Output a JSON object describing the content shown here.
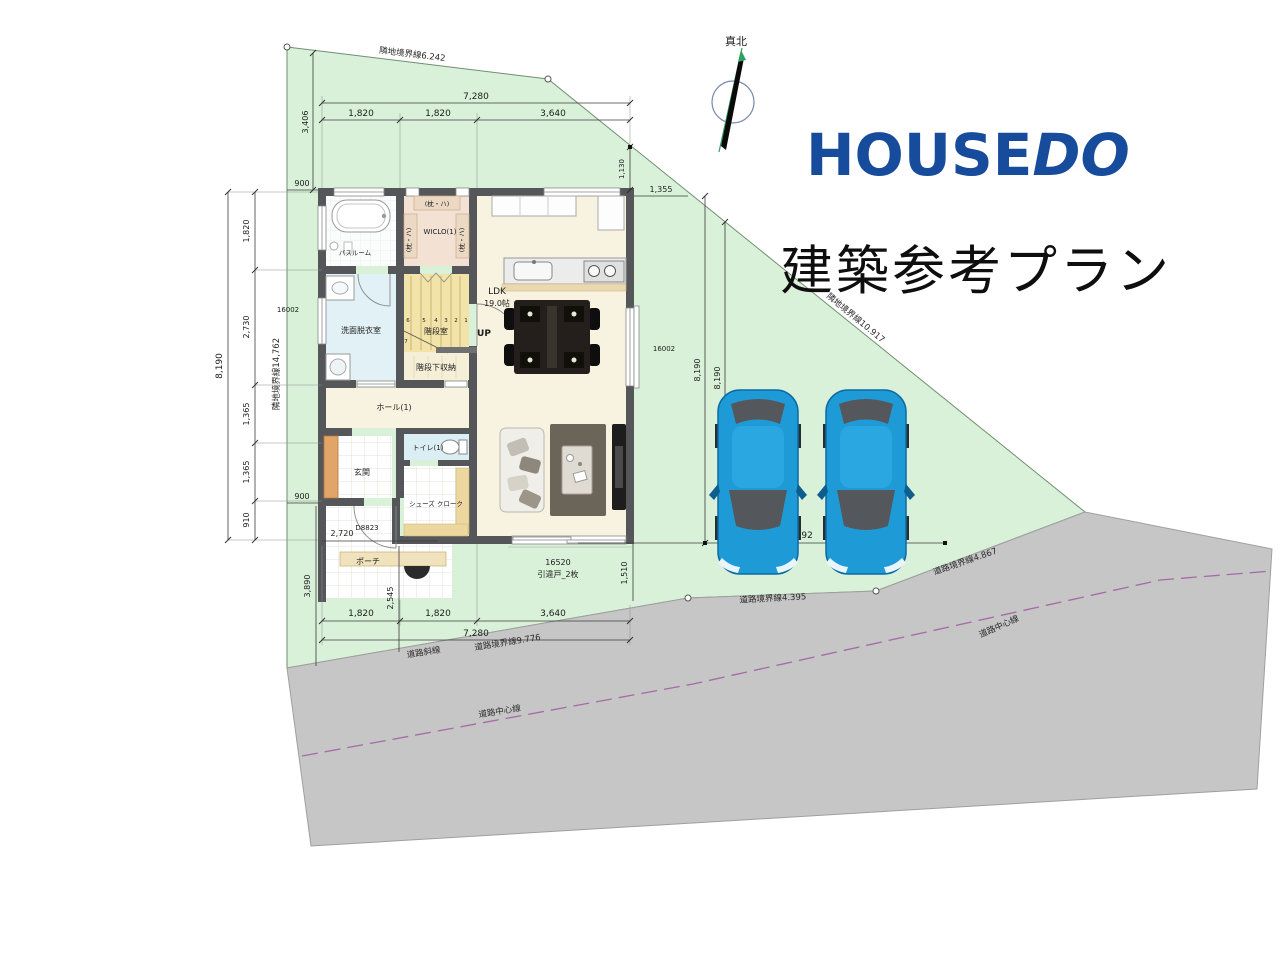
{
  "branding": {
    "logo_house": "HOUSE",
    "logo_do": "DO",
    "plan_title": "建築参考プラン"
  },
  "compass": {
    "north_label": "真北"
  },
  "boundaries": {
    "top": "隣地境界線6.242",
    "left": "隣地境界線14,762",
    "northeast": "隣地境界線10.917",
    "road_slant_prefix": "道路斜線",
    "road_bottom": "道路境界線9.776",
    "road_mid": "道路境界線4.395",
    "road_right": "道路境界線4.867",
    "road_center": "道路中心線"
  },
  "rooms": {
    "bath": "バスルーム",
    "wiclo": "WICLO(1)",
    "wiclo_shelf": "(枕・ハ)",
    "washroom": "洗面脱衣室",
    "ldk": "LDK",
    "ldk_size": "19.0帖",
    "hall": "ホール(1)",
    "toilet": "トイレ(1)",
    "entrance": "玄関",
    "shoe_closet": "シューズ クローク",
    "porch": "ポーチ",
    "stair_room": "階段室",
    "under_stair": "階段下収納",
    "up": "UP"
  },
  "stairs": {
    "numbers": [
      "6",
      "5",
      "4",
      "3",
      "2",
      "1"
    ],
    "landing": "7"
  },
  "openings": {
    "entry_door": "D8823",
    "front_window_code": "16520",
    "front_window_type": "引違戸_2枚",
    "left_window": "16002",
    "right_window": "16002"
  },
  "dims": {
    "top_overall": "7,280",
    "top_a": "1,820",
    "top_b": "1,820",
    "top_c": "3,640",
    "top_site_v": "3,406",
    "top_house_v": "1,130",
    "top_right_gap": "1,355",
    "top_left_gap": "900",
    "left_overall": "8,190",
    "left_a": "1,820",
    "left_b": "2,730",
    "left_c": "1,365",
    "left_d": "1,365",
    "left_e": "910",
    "left_gap_bottom": "900",
    "right_overall_a": "8,190",
    "right_overall_b": "8,190",
    "parking_width": "8,592",
    "bottom_overall": "7,280",
    "bottom_a": "1,820",
    "bottom_b": "1,820",
    "bottom_c": "3,640",
    "porch_width": "2,720",
    "porch_v": "3,890",
    "approach_v": "2,545",
    "front_gap_v": "1,510"
  }
}
